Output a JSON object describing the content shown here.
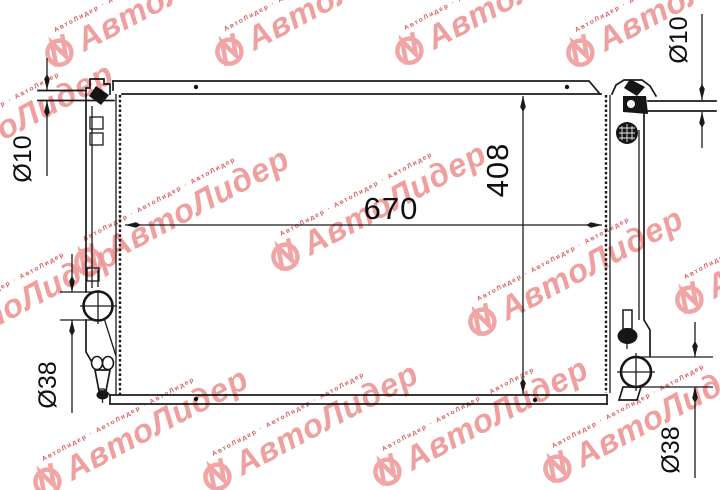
{
  "canvas": {
    "background": "#ffffff",
    "line_color": "#1b1b1b"
  },
  "diagram": {
    "subject": "radiator-outline-drawing",
    "dimension_labels": {
      "width": "670",
      "height": "408",
      "top_left_pipe": "Ø10",
      "top_right_pipe": "Ø10",
      "bottom_left_pipe": "Ø38",
      "bottom_right_pipe": "Ø38"
    }
  },
  "watermark": {
    "brand": "АвтоЛидер",
    "micro_text": "АвтоЛидер · АвтоЛидер · АвтоЛидер",
    "brand_color": "#ee8f8f",
    "accent_color": "#d34b4b"
  }
}
